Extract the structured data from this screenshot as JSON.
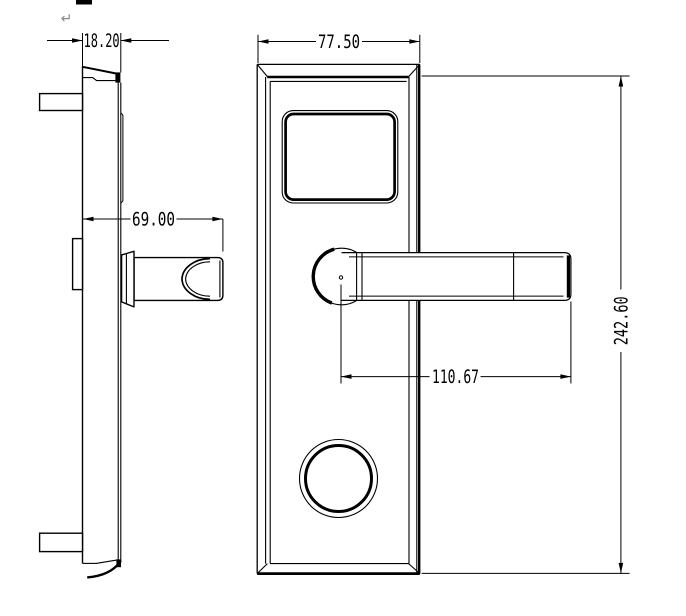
{
  "dimensions": {
    "plate_thickness": "18.20",
    "plate_width": "77.50",
    "handle_projection": "69.00",
    "handle_length": "110.67",
    "plate_height": "242.60"
  },
  "artifacts": {
    "return_symbol": "↵"
  },
  "colors": {
    "line": "#000000",
    "background": "#ffffff",
    "artifact_gray": "#8a8a8a"
  }
}
